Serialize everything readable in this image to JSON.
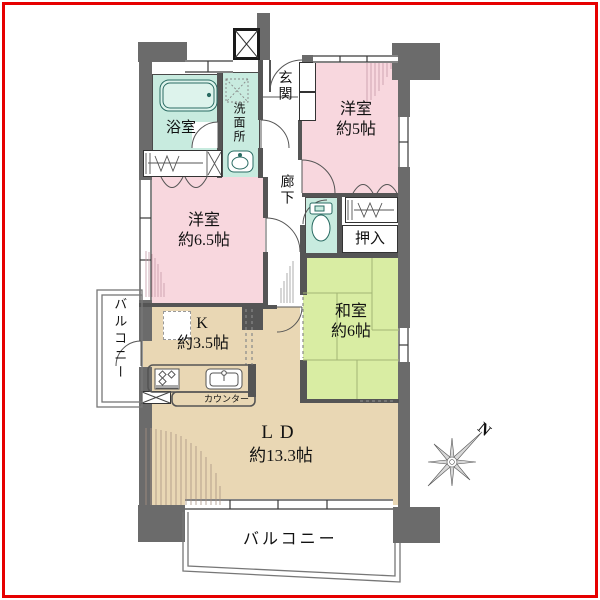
{
  "plan": {
    "rooms": {
      "western_room_small": {
        "name": "洋室",
        "size": "約5帖"
      },
      "western_room_large": {
        "name": "洋室",
        "size": "約6.5帖"
      },
      "japanese_room": {
        "name": "和室",
        "size": "約6帖"
      },
      "living_dining": {
        "name": "LD",
        "size": "約13.3帖"
      },
      "kitchen": {
        "name": "K",
        "size": "約3.5帖"
      }
    },
    "labels": {
      "bath": "浴室",
      "washroom": "洗面所",
      "entrance": "玄関",
      "corridor": "廊下",
      "closet_oshiire": "押入",
      "counter": "カウンター",
      "balcony_left": "バルコニー",
      "balcony_bottom": "バルコニー"
    },
    "compass": {
      "north": "N"
    },
    "colors": {
      "western_room": "#f8d7de",
      "japanese_room": "#d9eda3",
      "living_kitchen": "#e9d7b4",
      "wet_area": "#c8ebdf",
      "wall": "#6b6b6b",
      "frame": "#e60000"
    }
  }
}
